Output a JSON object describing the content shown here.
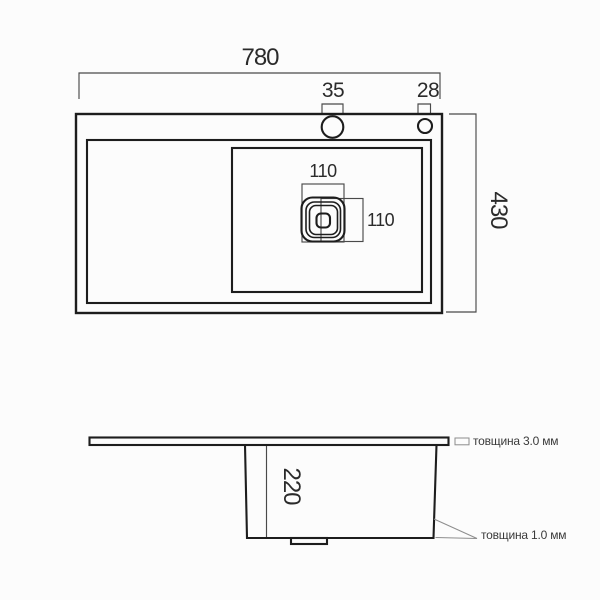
{
  "title": "Kitchen sink technical drawing",
  "top_view": {
    "overall_width_label": "780",
    "faucet_hole_large_label": "35",
    "faucet_hole_small_label": "28",
    "overall_depth_label": "430",
    "drain_width_label": "110",
    "drain_height_label": "110"
  },
  "side_view": {
    "bowl_depth_label": "220",
    "rim_thickness_note": "товщина 3.0 мм",
    "wall_thickness_note": "товщина 1.0 мм"
  },
  "colors": {
    "line": "#1d1d1d",
    "dim": "#4a4a4a",
    "annotation": "#8d8d8d",
    "background": "#fcfcfc"
  }
}
